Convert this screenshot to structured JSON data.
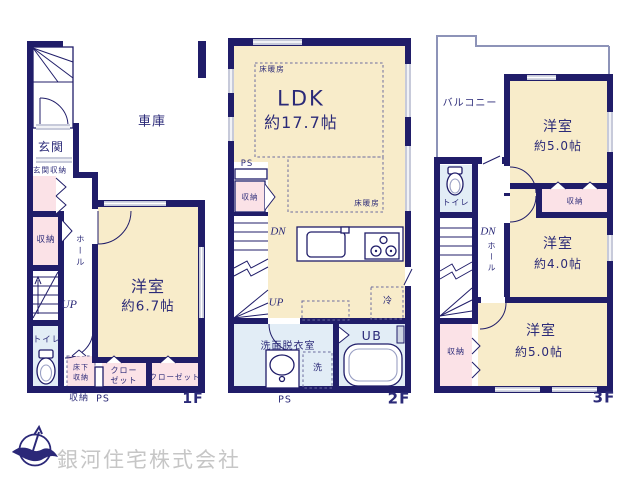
{
  "title": "間取り図",
  "colors": {
    "wall": "#201d69",
    "room_cream": "#f8ecca",
    "storage_pink": "#fbe2e7",
    "wet_blue": "#e2edf6",
    "window_gray": "#c7cada",
    "label_navy": "#2b2a78",
    "dash_navy": "#6b6b9e",
    "company_gray": "#c6c6c6"
  },
  "icons": {
    "compass": "north-compass-icon",
    "toilet": "toilet-icon",
    "bathtub": "bathtub-icon",
    "washbasin": "washbasin-icon",
    "kitchen_sink": "kitchen-sink-icon",
    "stove": "stove-icon"
  },
  "floors": {
    "f1": {
      "garage": "車庫",
      "entrance": "玄関",
      "entrance_storage": "玄関収納",
      "storage": "収納",
      "hall": "ホール",
      "up": "UP",
      "toilet": "トイレ",
      "underfloor_storage_line1": "床下",
      "underfloor_storage_line2": "収納",
      "storage_below": "収納",
      "ps": "PS",
      "closet1_line1": "クロー",
      "closet1_line2": "ゼット",
      "closet2": "クローゼット",
      "room": "洋室",
      "room_size": "約6.7帖",
      "tag": "1F"
    },
    "f2": {
      "floor_heating_top": "床暖房",
      "ldk": "LDK",
      "ldk_size": "約17.7帖",
      "ps_top": "PS",
      "storage": "収納",
      "dn": "DN",
      "up": "UP",
      "floor_heating_bottom": "床暖房",
      "fridge": "冷",
      "washroom": "洗面脱衣室",
      "washer": "洗",
      "unit_bath": "UB",
      "ps_bottom": "PS",
      "tag": "2F"
    },
    "f3": {
      "balcony": "バルコニー",
      "room_top": "洋室",
      "room_top_size": "約5.0帖",
      "storage_top": "収納",
      "room_mid": "洋室",
      "room_mid_size": "約4.0帖",
      "toilet": "トイレ",
      "dn": "DN",
      "hall": "ホール",
      "storage_left": "収納",
      "room_bottom": "洋室",
      "room_bottom_size": "約5.0帖",
      "tag": "3F"
    }
  },
  "branding": {
    "company": "銀河住宅株式会社"
  }
}
